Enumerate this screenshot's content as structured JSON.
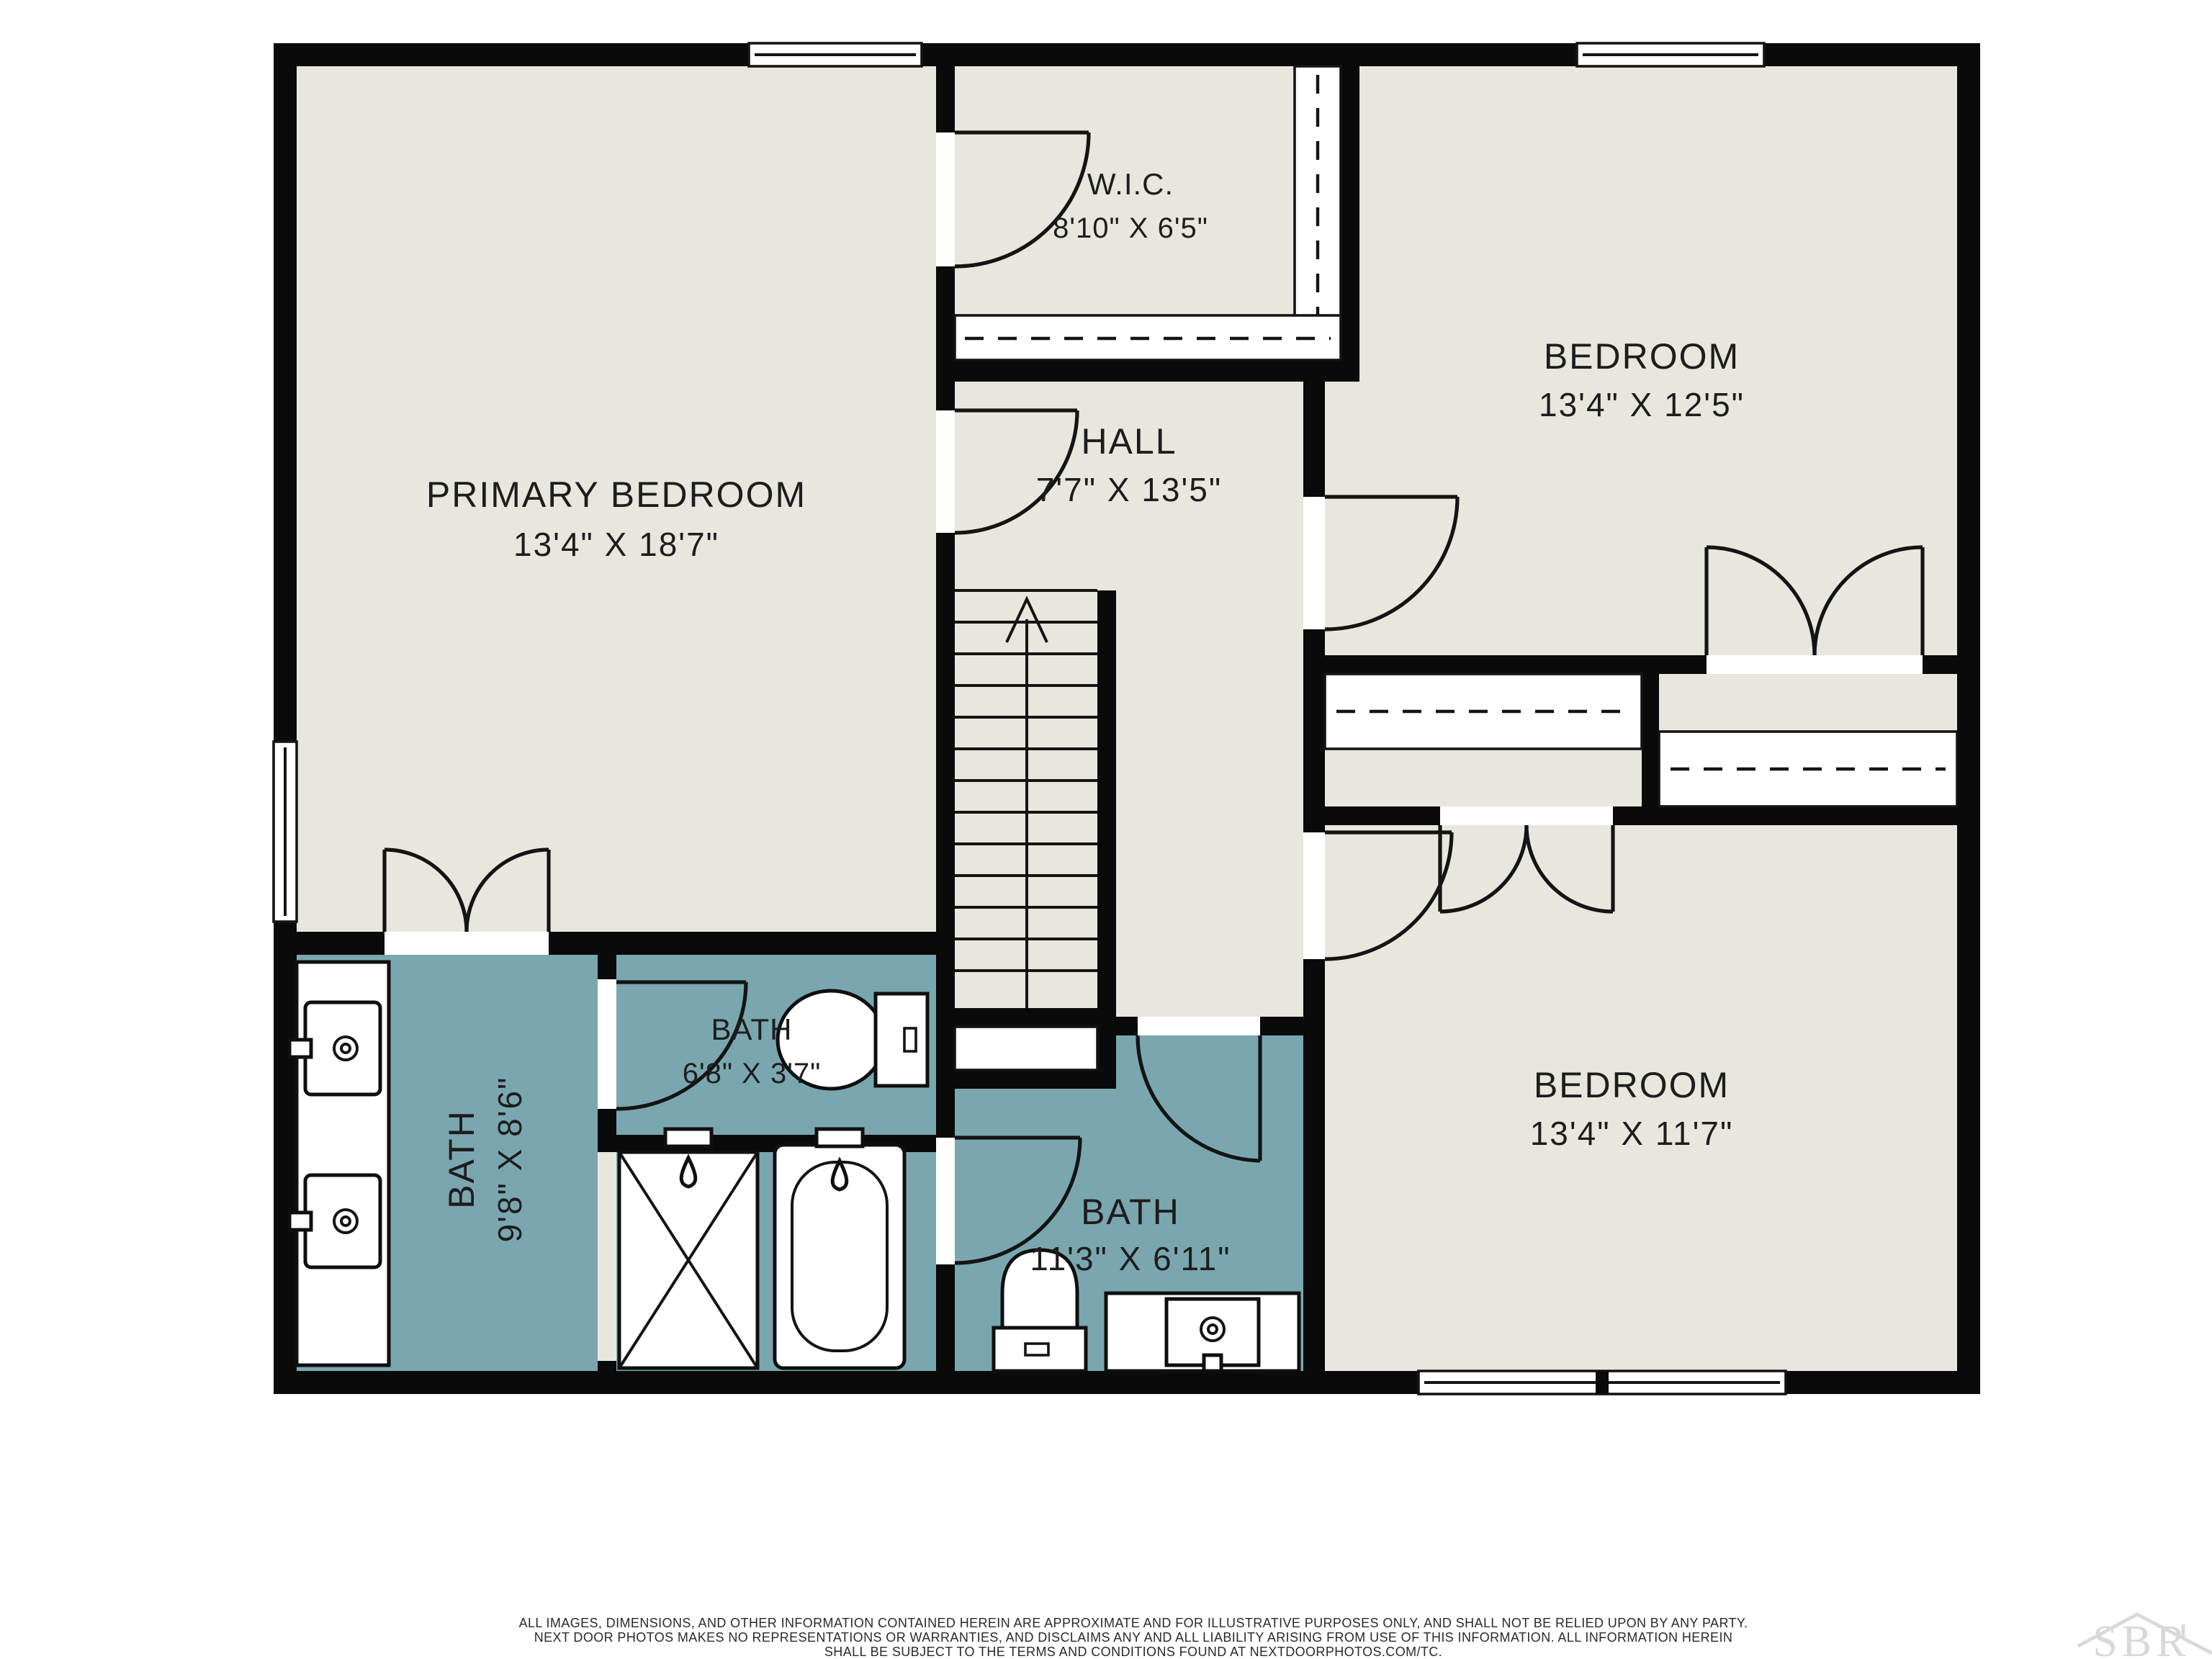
{
  "rooms": {
    "primary_bedroom": {
      "name": "PRIMARY BEDROOM",
      "dims": "13'4\" X 18'7\""
    },
    "wic": {
      "name": "W.I.C.",
      "dims": "8'10\" X 6'5\""
    },
    "hall": {
      "name": "HALL",
      "dims": "7'7\" X 13'5\""
    },
    "bedroom_upper": {
      "name": "BEDROOM",
      "dims": "13'4\" X 12'5\""
    },
    "bedroom_lower": {
      "name": "BEDROOM",
      "dims": "13'4\" X 11'7\""
    },
    "bath_primary": {
      "name": "BATH",
      "dims": "9'8\" X 8'6\""
    },
    "bath_small": {
      "name": "BATH",
      "dims": "6'8\" X 3'7\""
    },
    "bath_hall": {
      "name": "BATH",
      "dims": "11'3\" X 6'11\""
    }
  },
  "colors": {
    "floor": "#E8E7DE",
    "bath_floor": "#7AA7AF",
    "walls": "#0A0A0A",
    "label_text": "#1D1D1D",
    "watermark": "#D9D9D9"
  },
  "footer": {
    "disclaimer": [
      "ALL IMAGES, DIMENSIONS, AND OTHER INFORMATION CONTAINED HEREIN ARE APPROXIMATE AND FOR ILLUSTRATIVE PURPOSES ONLY, AND SHALL NOT BE RELIED UPON BY ANY PARTY.",
      "NEXT DOOR PHOTOS MAKES NO REPRESENTATIONS OR WARRANTIES, AND DISCLAIMS ANY AND ALL LIABILITY ARISING FROM USE OF THIS INFORMATION. ALL INFORMATION HEREIN",
      "SHALL BE SUBJECT TO THE TERMS AND CONDITIONS FOUND AT NEXTDOORPHOTOS.COM/TC."
    ]
  },
  "watermark": {
    "text": "SBR"
  }
}
